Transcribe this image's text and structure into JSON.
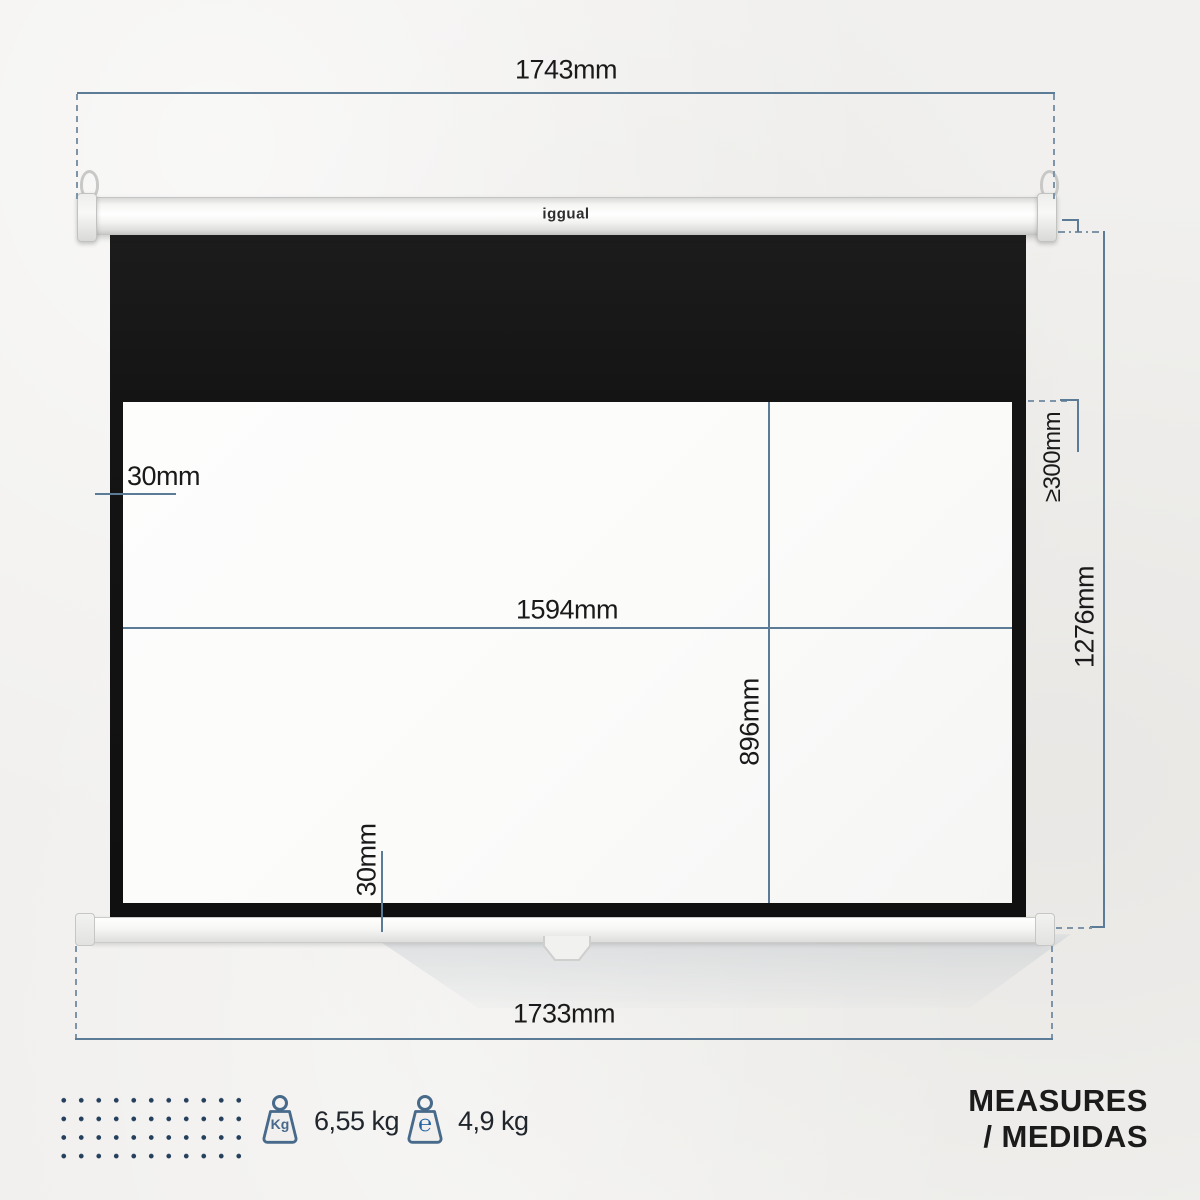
{
  "product": {
    "brand_logo": "iggual"
  },
  "dimension_labels": {
    "case_width": "1743mm",
    "bar_width": "1733mm",
    "viewing_width": "1594mm",
    "viewing_height": "896mm",
    "total_height": "1276mm",
    "top_drop": "≥300mm",
    "side_border": "30mm",
    "bottom_border": "30mm"
  },
  "specs": [
    {
      "icon": "kg-weight-icon",
      "badge": "Kg",
      "value": "6,55 kg"
    },
    {
      "icon": "estimated-weight-icon",
      "badge": "℮",
      "value": "4,9 kg"
    }
  ],
  "footer": {
    "title_line1": "MEASURES",
    "title_line2": "/ MEDIDAS"
  },
  "colors": {
    "dimension_line": "#5b7b96",
    "dashed_line": "#7e95a9",
    "label_text": "#1a1a1a",
    "dot_pattern": "#24405c",
    "icon_stroke": "#47698a",
    "estimated_blue": "#2563a3",
    "fabric_black": "#141414",
    "wall_background": "#f1f0ee"
  }
}
